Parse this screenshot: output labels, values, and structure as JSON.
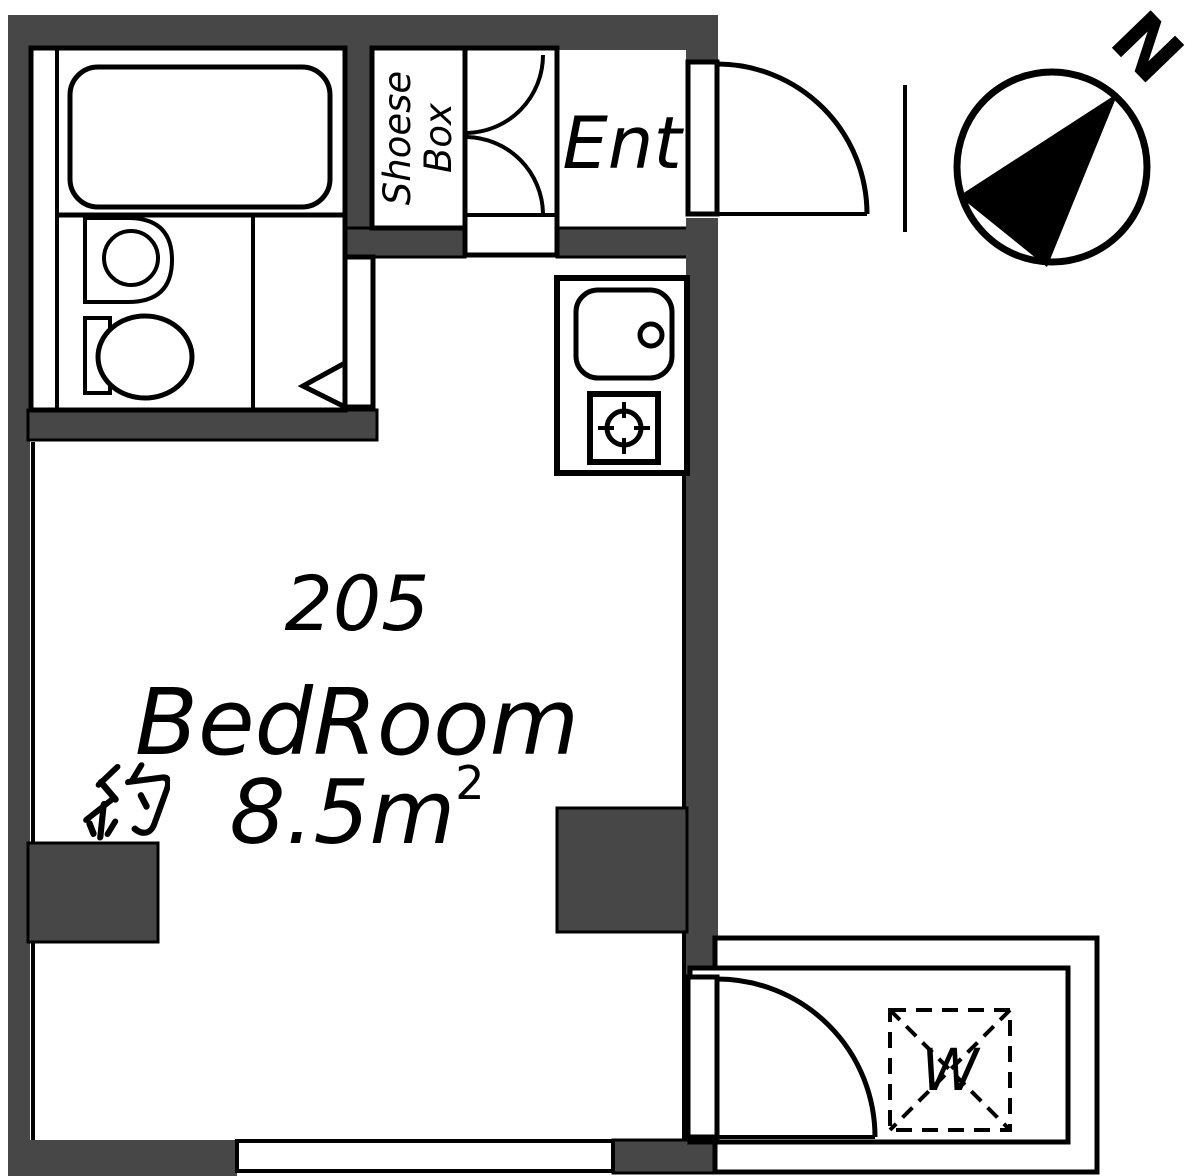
{
  "colors": {
    "wall": "#474747",
    "line": "#000000",
    "floor": "#ffffff"
  },
  "labels": {
    "unit_number": "205",
    "room_name": "BedRoom",
    "room_area": "約8.5m²",
    "room_area_value": "8.5m",
    "room_area_superscript": "2",
    "entrance": "Ent",
    "shoe_box_line1": "Shoese",
    "shoe_box_line2": "Box",
    "washing_machine": "W",
    "compass_north": "N"
  },
  "icons": {
    "compass_needle": "filled-triangle-pointing-northeast",
    "kanji_yaku": "kanji-approx-drawn-as-strokes",
    "stove_burner": "circle-with-crosshair",
    "washer_space": "dashed-square-with-x",
    "door_swings": "quarter-circle-arcs"
  }
}
